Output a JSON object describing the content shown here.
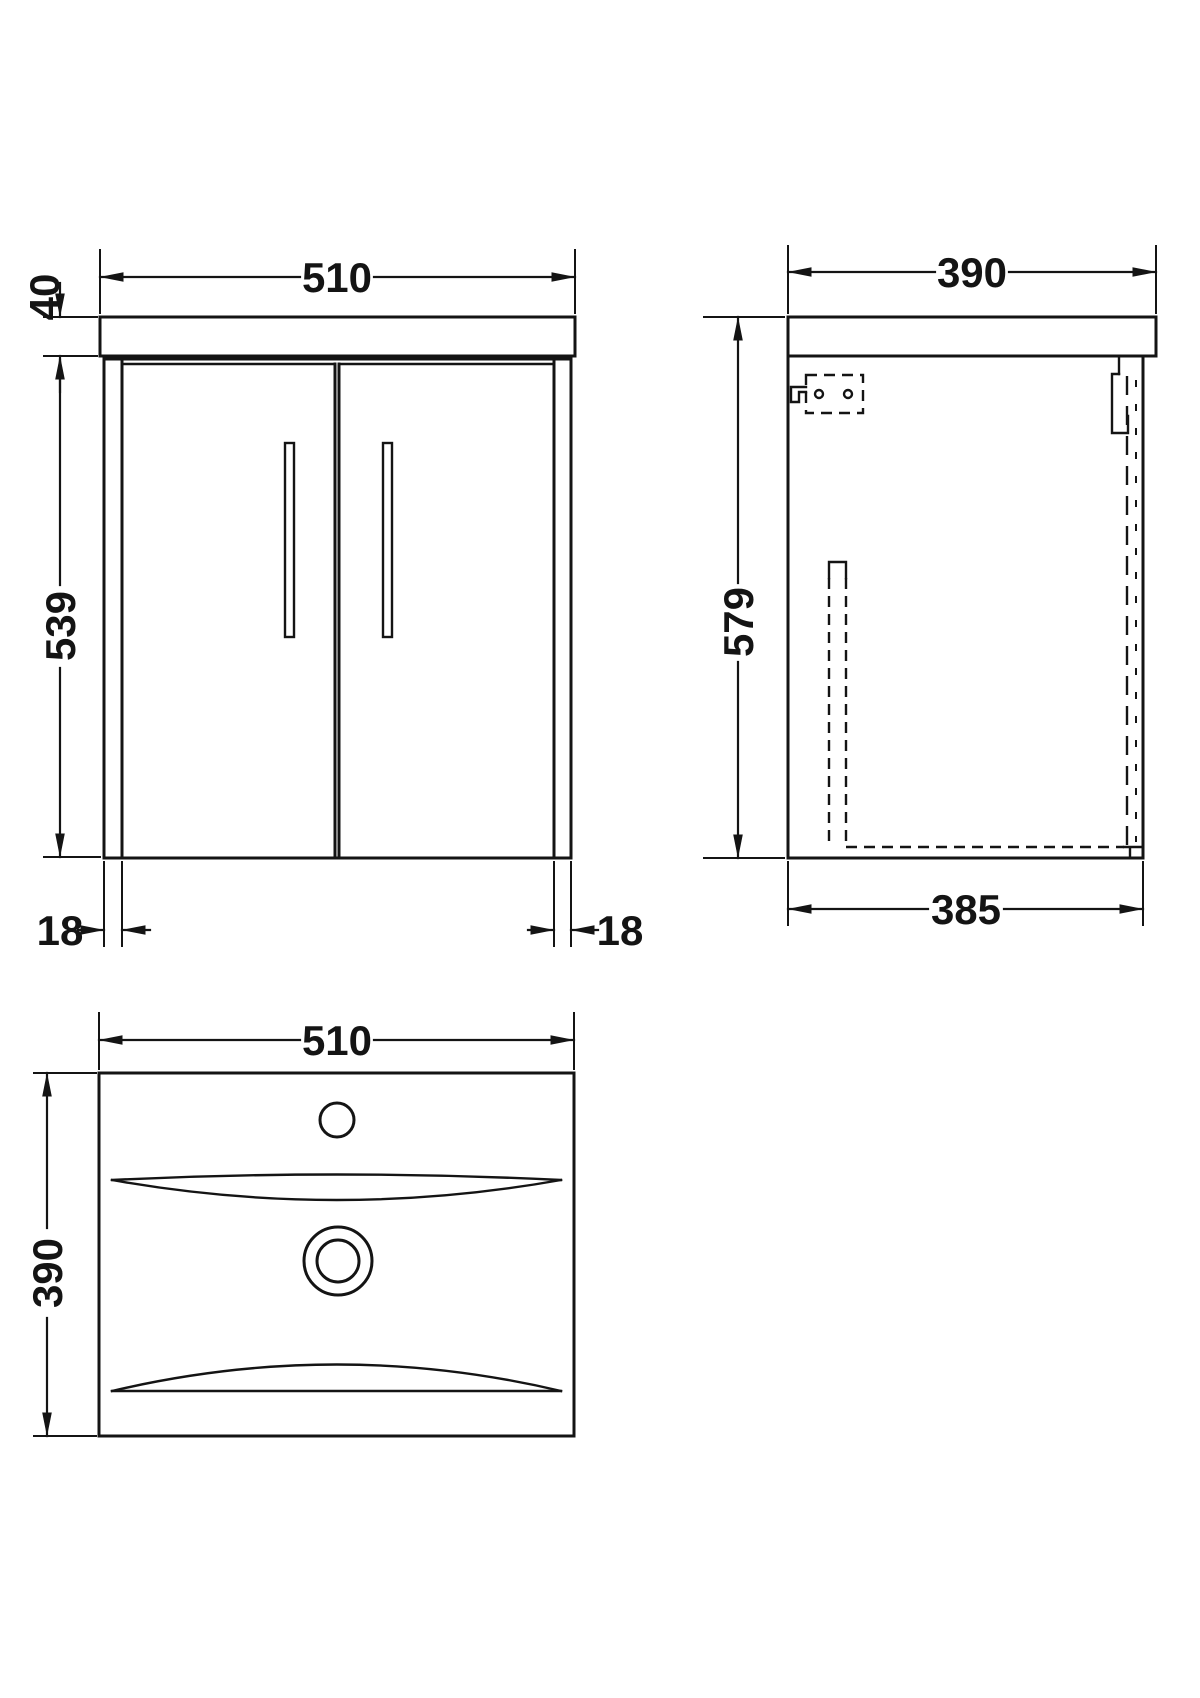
{
  "drawing": {
    "type": "technical-dimension-drawing",
    "subject": "wall-hung vanity unit with two doors and basin",
    "colors": {
      "line": "#141414",
      "background": "#ffffff"
    },
    "front_view": {
      "width_label": "510",
      "worktop_thickness_label": "40",
      "cabinet_height_label": "539",
      "left_panel_label": "18",
      "right_panel_label": "18"
    },
    "side_view": {
      "depth_label": "390",
      "overall_height_label": "579",
      "cabinet_depth_label": "385"
    },
    "plan_view": {
      "width_label": "510",
      "depth_label": "390"
    }
  }
}
